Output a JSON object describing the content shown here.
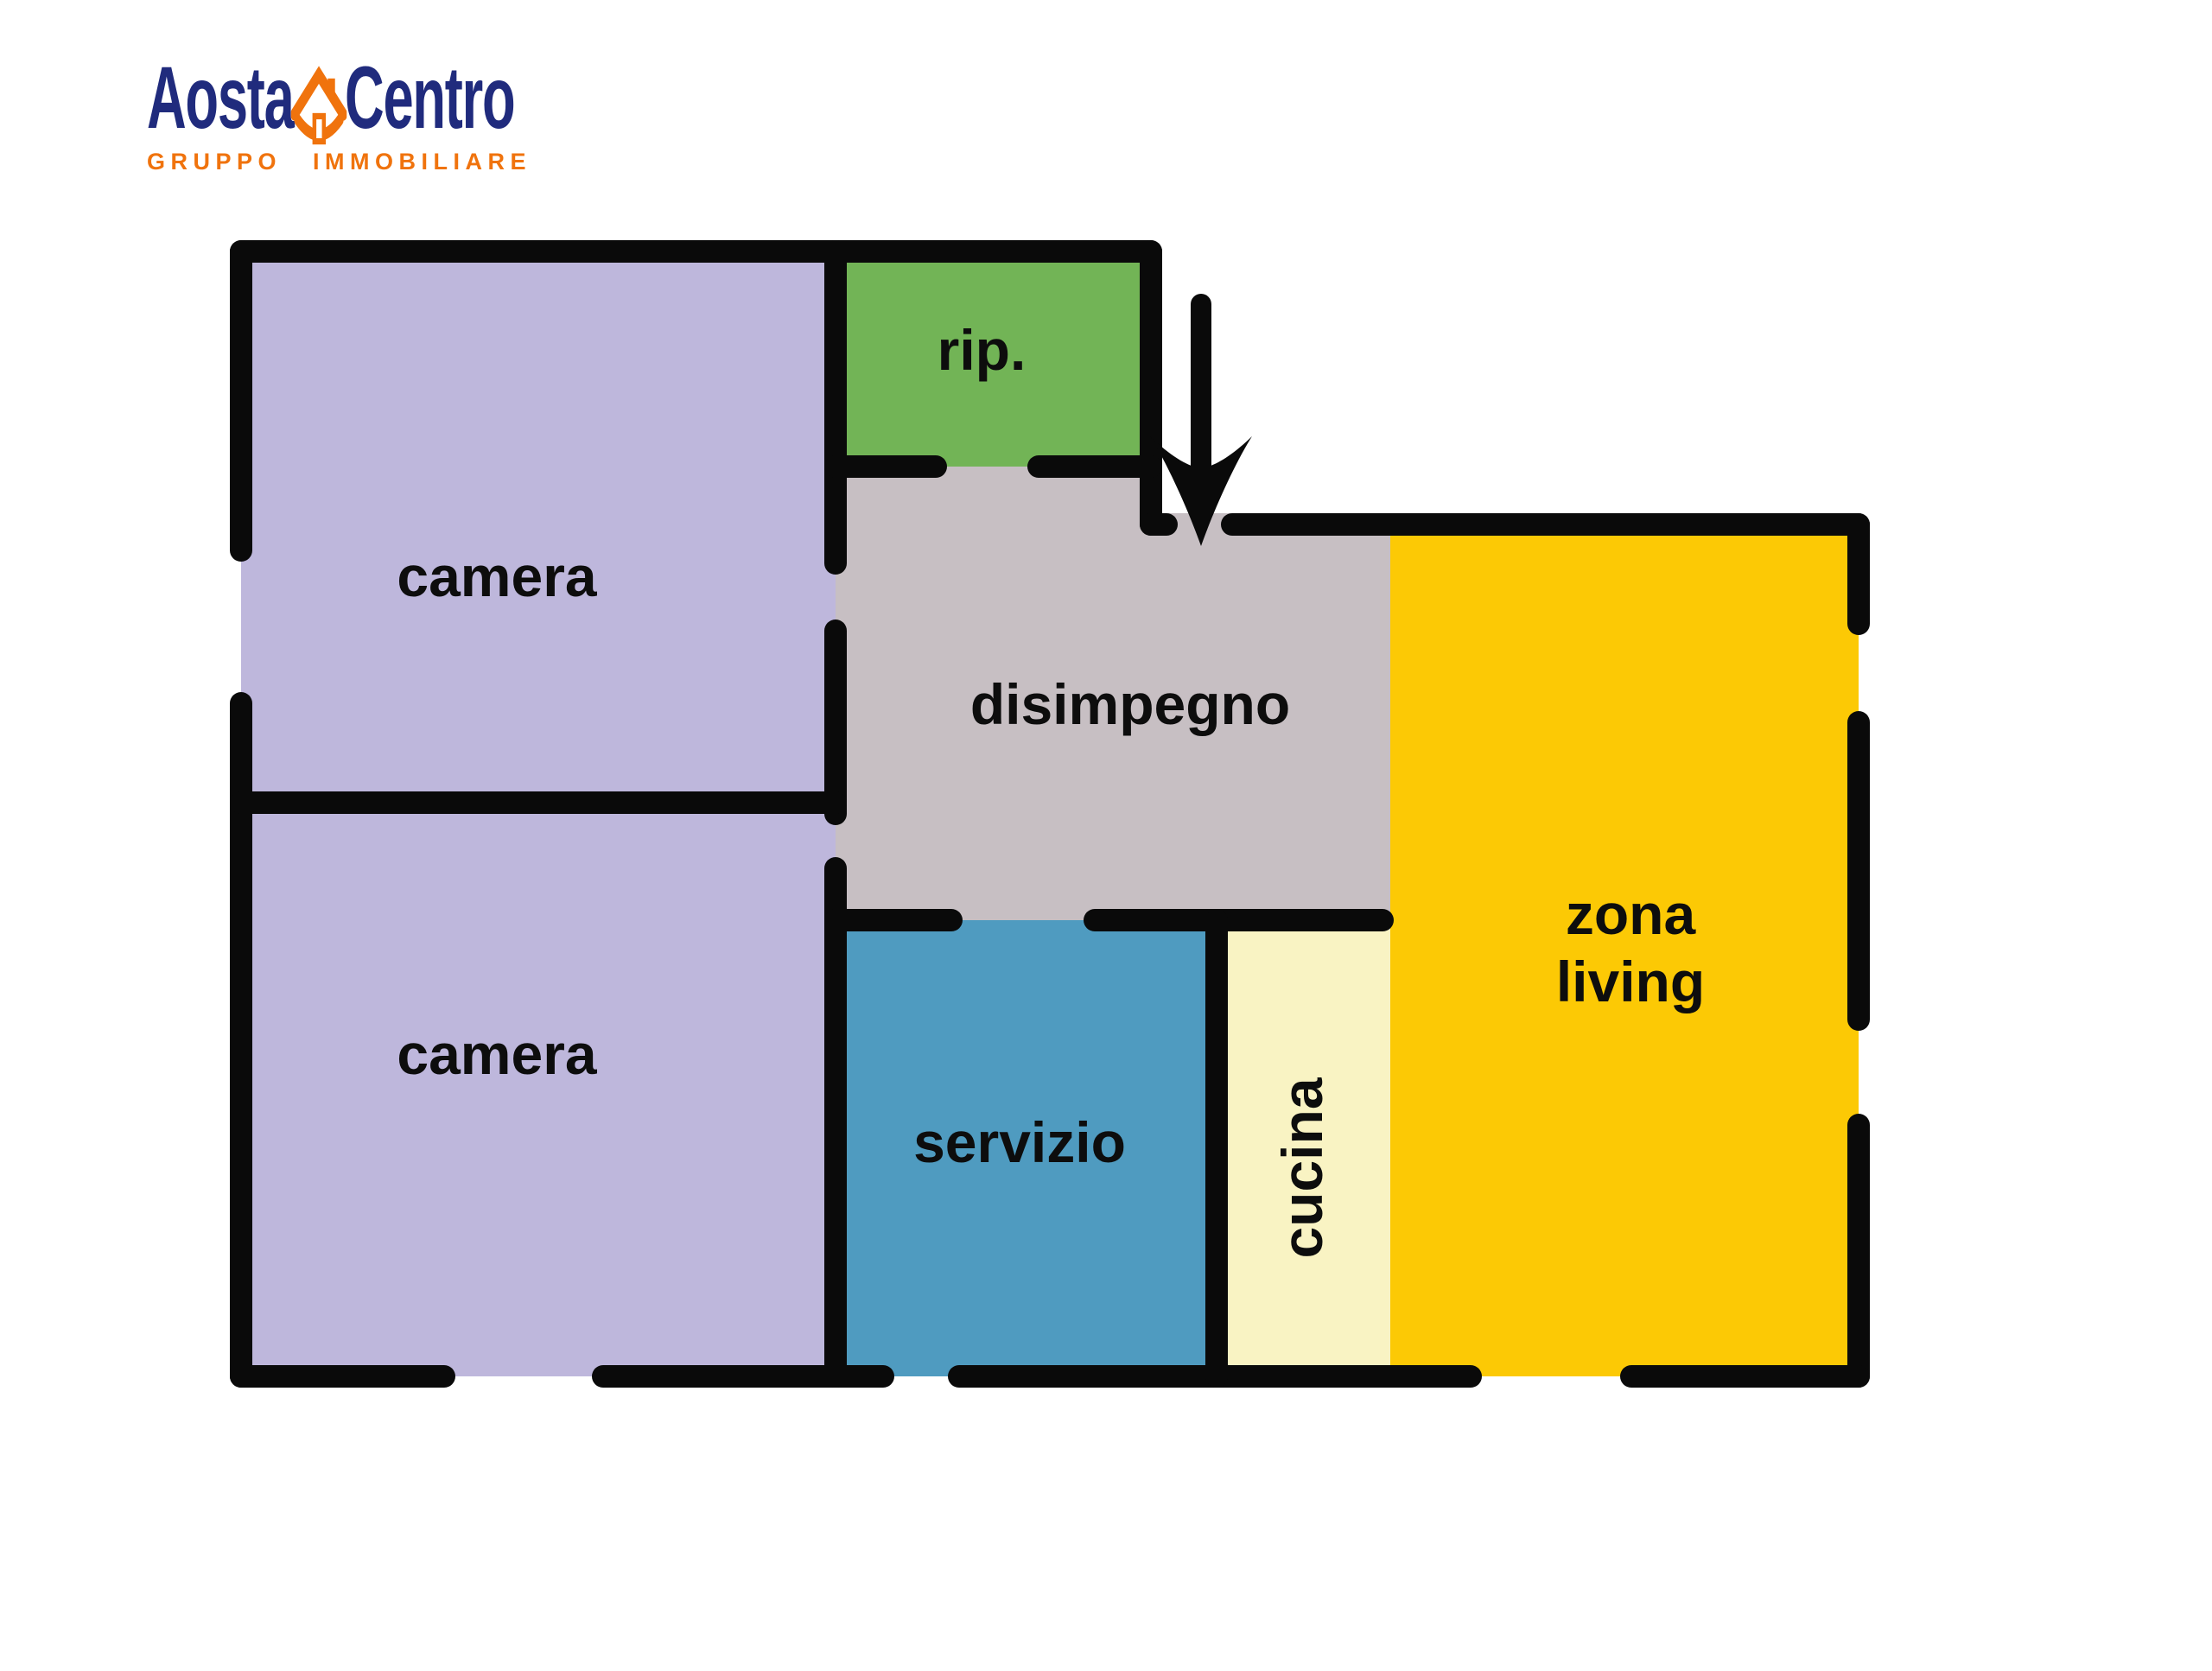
{
  "page": {
    "background": "#ffffff"
  },
  "logo": {
    "brand_primary": "Aosta",
    "brand_secondary": "Centro",
    "tagline": "GRUPPO IMMOBILIARE",
    "color_navy": "#202B7D",
    "color_orange": "#F0730D",
    "house_icon": "house-with-chimney"
  },
  "floorplan": {
    "wall_color": "#0A0A0A",
    "label_color": "#0D0D0D",
    "entrance_arrow_direction": "down",
    "rooms": {
      "camera_top": {
        "label": "camera",
        "color": "#BEB7DC"
      },
      "camera_bottom": {
        "label": "camera",
        "color": "#BEB7DC"
      },
      "ripostiglio": {
        "label": "rip.",
        "color": "#72B456"
      },
      "disimpegno": {
        "label": "disimpegno",
        "color": "#C7BFC3"
      },
      "servizio": {
        "label": "servizio",
        "color": "#4F9BC0"
      },
      "cucina": {
        "label": "cucina",
        "color": "#F9F3C3"
      },
      "zona_living": {
        "label_line1": "zona",
        "label_line2": "living",
        "color": "#FCC905"
      }
    }
  }
}
